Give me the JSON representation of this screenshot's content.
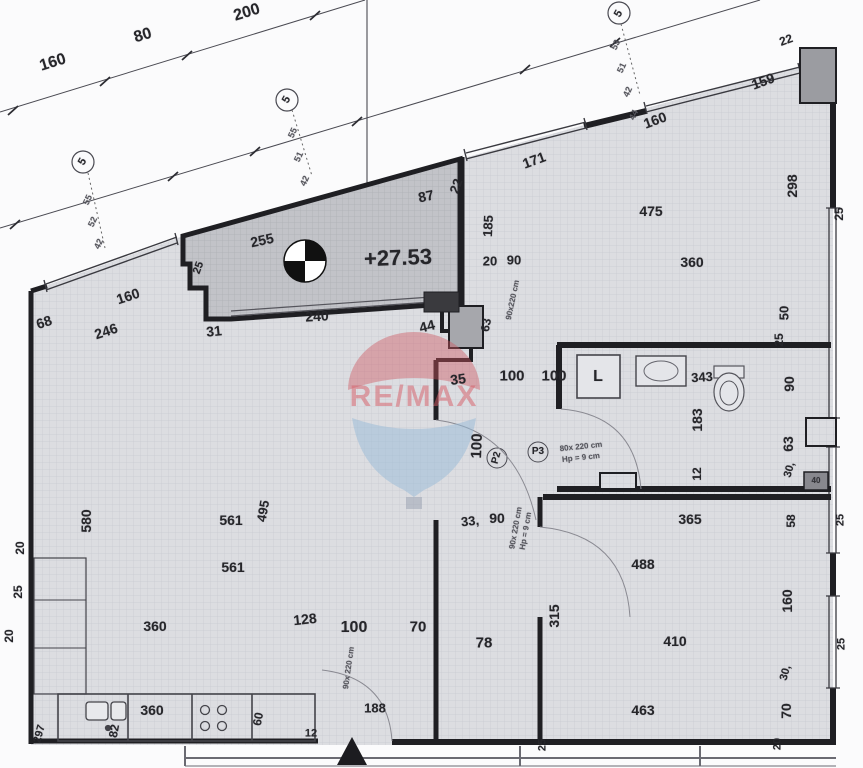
{
  "plan": {
    "elevation_marker": "+27.53",
    "watermark_brand": "RE/MAX",
    "colors": {
      "wall": "#1f1f23",
      "room_fill": "#dcdde1",
      "room_grid": "#c7c9d1",
      "terrace_fill": "#c2c3c8",
      "terrace_grid": "#aeb0b6",
      "watermark_red": "rgba(206,84,92,0.42)",
      "watermark_blue": "rgba(150,185,215,0.5)",
      "paper": "#fbfbfc"
    }
  },
  "labels": [
    {
      "t": "160",
      "x": 53,
      "y": 63,
      "r": -17,
      "s": 16
    },
    {
      "t": "80",
      "x": 143,
      "y": 36,
      "r": -17,
      "s": 16
    },
    {
      "t": "200",
      "x": 247,
      "y": 13,
      "r": -17,
      "s": 16
    },
    {
      "t": "5",
      "x": 83,
      "y": 162,
      "r": -60,
      "s": 11,
      "n": "window-marker"
    },
    {
      "t": "5",
      "x": 287,
      "y": 100,
      "r": -60,
      "s": 11,
      "n": "window-marker"
    },
    {
      "t": "5",
      "x": 619,
      "y": 14,
      "r": -60,
      "s": 11,
      "n": "window-marker"
    },
    {
      "t": "55",
      "x": 88,
      "y": 200,
      "r": -65,
      "s": 9,
      "c": "#55555c"
    },
    {
      "t": "52",
      "x": 93,
      "y": 222,
      "r": -65,
      "s": 9,
      "c": "#55555c"
    },
    {
      "t": "42",
      "x": 99,
      "y": 244,
      "r": -65,
      "s": 9,
      "c": "#55555c"
    },
    {
      "t": "55",
      "x": 293,
      "y": 133,
      "r": -65,
      "s": 9,
      "c": "#55555c"
    },
    {
      "t": "51",
      "x": 299,
      "y": 157,
      "r": -65,
      "s": 9,
      "c": "#55555c"
    },
    {
      "t": "42",
      "x": 305,
      "y": 181,
      "r": -65,
      "s": 9,
      "c": "#55555c"
    },
    {
      "t": "53",
      "x": 616,
      "y": 45,
      "r": -65,
      "s": 9,
      "c": "#55555c"
    },
    {
      "t": "51",
      "x": 622,
      "y": 68,
      "r": -65,
      "s": 9,
      "c": "#55555c"
    },
    {
      "t": "42",
      "x": 628,
      "y": 92,
      "r": -65,
      "s": 9,
      "c": "#55555c"
    },
    {
      "t": "44",
      "x": 634,
      "y": 115,
      "r": -65,
      "s": 9,
      "c": "#55555c"
    },
    {
      "t": "68",
      "x": 44,
      "y": 322,
      "r": -18
    },
    {
      "t": "246",
      "x": 106,
      "y": 331,
      "r": -18
    },
    {
      "t": "160",
      "x": 128,
      "y": 296,
      "r": -18
    },
    {
      "t": "31",
      "x": 214,
      "y": 331,
      "r": -6
    },
    {
      "t": "240",
      "x": 317,
      "y": 316,
      "r": -3
    },
    {
      "t": "25",
      "x": 199,
      "y": 268,
      "r": -70,
      "s": 11
    },
    {
      "t": "255",
      "x": 262,
      "y": 240,
      "r": -12
    },
    {
      "t": "87",
      "x": 426,
      "y": 196,
      "r": -12
    },
    {
      "t": "+27.53",
      "x": 398,
      "y": 258,
      "r": -2,
      "s": 22,
      "n": "elevation-value"
    },
    {
      "t": "44",
      "x": 427,
      "y": 326,
      "r": -14
    },
    {
      "t": "63",
      "x": 486,
      "y": 325,
      "r": -80,
      "s": 12
    },
    {
      "t": "22",
      "x": 456,
      "y": 186,
      "r": -70,
      "s": 13
    },
    {
      "t": "185",
      "x": 488,
      "y": 226,
      "r": -87,
      "s": 13
    },
    {
      "t": "20",
      "x": 490,
      "y": 261,
      "s": 13
    },
    {
      "t": "90",
      "x": 514,
      "y": 260,
      "s": 13
    },
    {
      "t": "90x220 cm",
      "x": 513,
      "y": 300,
      "r": -78,
      "s": 8,
      "c": "#55555c"
    },
    {
      "t": "35",
      "x": 458,
      "y": 379,
      "r": -8
    },
    {
      "t": "100",
      "x": 512,
      "y": 376,
      "s": 15
    },
    {
      "t": "100",
      "x": 554,
      "y": 376,
      "s": 15
    },
    {
      "t": "100",
      "x": 477,
      "y": 446,
      "r": -88,
      "s": 15
    },
    {
      "t": "P2",
      "x": 497,
      "y": 458,
      "r": -75,
      "s": 10,
      "n": "door-marker-p2"
    },
    {
      "t": "P3",
      "x": 538,
      "y": 452,
      "s": 10,
      "n": "door-marker-p3"
    },
    {
      "t": "80x 220 cm",
      "x": 581,
      "y": 447,
      "r": -6,
      "s": 8,
      "c": "#55555c"
    },
    {
      "t": "Hp = 9 cm",
      "x": 581,
      "y": 458,
      "r": -6,
      "s": 8,
      "c": "#55555c"
    },
    {
      "t": "90x 220 cm",
      "x": 516,
      "y": 528,
      "r": -80,
      "s": 8,
      "c": "#55555c"
    },
    {
      "t": "Hp = 9 cm",
      "x": 526,
      "y": 531,
      "r": -80,
      "s": 8,
      "c": "#55555c"
    },
    {
      "t": "171",
      "x": 534,
      "y": 160,
      "r": -20
    },
    {
      "t": "160",
      "x": 655,
      "y": 120,
      "r": -20
    },
    {
      "t": "159",
      "x": 763,
      "y": 81,
      "r": -20
    },
    {
      "t": "22",
      "x": 786,
      "y": 40,
      "r": -20,
      "s": 12
    },
    {
      "t": "475",
      "x": 651,
      "y": 211
    },
    {
      "t": "360",
      "x": 692,
      "y": 262
    },
    {
      "t": "298",
      "x": 792,
      "y": 186,
      "r": -90
    },
    {
      "t": "25",
      "x": 839,
      "y": 214,
      "r": -90,
      "s": 12
    },
    {
      "t": "50",
      "x": 784,
      "y": 313,
      "r": -90,
      "s": 13
    },
    {
      "t": "25",
      "x": 779,
      "y": 340,
      "r": -90,
      "s": 12
    },
    {
      "t": "L",
      "x": 598,
      "y": 377,
      "s": 16,
      "n": "washing-machine-label"
    },
    {
      "t": "343",
      "x": 702,
      "y": 377,
      "r": -4,
      "s": 13
    },
    {
      "t": "183",
      "x": 697,
      "y": 420,
      "r": -90
    },
    {
      "t": "90",
      "x": 789,
      "y": 384,
      "r": -90
    },
    {
      "t": "63",
      "x": 788,
      "y": 444,
      "r": -90
    },
    {
      "t": "30,",
      "x": 790,
      "y": 470,
      "r": -75,
      "s": 11
    },
    {
      "t": "12",
      "x": 697,
      "y": 474,
      "r": -90,
      "s": 12
    },
    {
      "t": "40",
      "x": 816,
      "y": 481,
      "s": 8,
      "c": "#333338"
    },
    {
      "t": "365",
      "x": 690,
      "y": 519
    },
    {
      "t": "488",
      "x": 643,
      "y": 564
    },
    {
      "t": "410",
      "x": 675,
      "y": 641
    },
    {
      "t": "463",
      "x": 643,
      "y": 710
    },
    {
      "t": "315",
      "x": 554,
      "y": 616,
      "r": -90
    },
    {
      "t": "33,",
      "x": 470,
      "y": 521,
      "r": -6,
      "s": 13
    },
    {
      "t": "90",
      "x": 497,
      "y": 518,
      "s": 14
    },
    {
      "t": "58",
      "x": 791,
      "y": 521,
      "r": -90,
      "s": 12
    },
    {
      "t": "160",
      "x": 787,
      "y": 601,
      "r": -90
    },
    {
      "t": "30,",
      "x": 786,
      "y": 673,
      "r": -75,
      "s": 11
    },
    {
      "t": "70",
      "x": 786,
      "y": 711,
      "r": -90
    },
    {
      "t": "25",
      "x": 841,
      "y": 520,
      "r": -90,
      "s": 11
    },
    {
      "t": "25",
      "x": 842,
      "y": 644,
      "r": -90,
      "s": 11
    },
    {
      "t": "20",
      "x": 778,
      "y": 744,
      "r": -90,
      "s": 11
    },
    {
      "t": "25",
      "x": 543,
      "y": 745,
      "r": -90,
      "s": 11
    },
    {
      "t": "128",
      "x": 305,
      "y": 619,
      "r": -6
    },
    {
      "t": "100",
      "x": 354,
      "y": 628,
      "s": 16
    },
    {
      "t": "70",
      "x": 418,
      "y": 627,
      "s": 15
    },
    {
      "t": "78",
      "x": 484,
      "y": 643,
      "s": 15
    },
    {
      "t": "188",
      "x": 375,
      "y": 708,
      "s": 13
    },
    {
      "t": "90x 220 cm",
      "x": 349,
      "y": 668,
      "r": -82,
      "s": 8,
      "c": "#55555c"
    },
    {
      "t": "12",
      "x": 311,
      "y": 734,
      "s": 11
    },
    {
      "t": "580",
      "x": 86,
      "y": 521,
      "r": -90
    },
    {
      "t": "561",
      "x": 231,
      "y": 520
    },
    {
      "t": "495",
      "x": 263,
      "y": 511,
      "r": -80,
      "s": 13
    },
    {
      "t": "561",
      "x": 233,
      "y": 567
    },
    {
      "t": "360",
      "x": 155,
      "y": 626
    },
    {
      "t": "20",
      "x": 20,
      "y": 548,
      "r": -90,
      "s": 12
    },
    {
      "t": "25",
      "x": 18,
      "y": 592,
      "r": -90,
      "s": 12
    },
    {
      "t": "20",
      "x": 9,
      "y": 636,
      "r": -90,
      "s": 12
    },
    {
      "t": "360",
      "x": 152,
      "y": 710
    },
    {
      "t": "82",
      "x": 114,
      "y": 731,
      "r": -80,
      "s": 12
    },
    {
      "t": "60",
      "x": 258,
      "y": 719,
      "r": -80,
      "s": 12
    },
    {
      "t": "297",
      "x": 40,
      "y": 734,
      "r": -75,
      "s": 11
    },
    {
      "t": "RE/MAX",
      "x": 414,
      "y": 397,
      "s": 30,
      "c": "rgba(214,90,100,0.5)",
      "n": "watermark-text",
      "cls": "wm"
    }
  ]
}
